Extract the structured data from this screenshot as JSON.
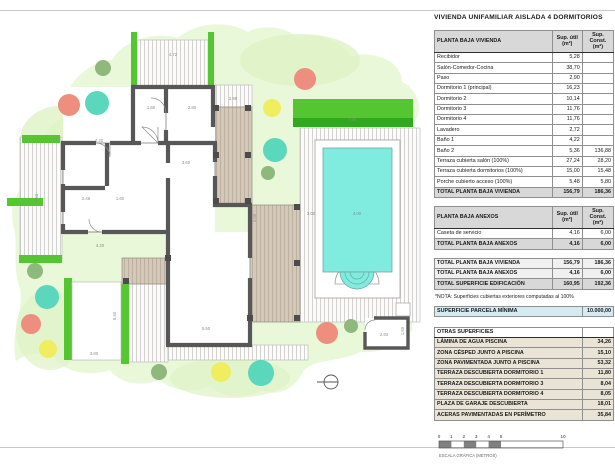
{
  "title": "VIVIENDA UNIFAMILIAR AISLADA 4 DORMITORIOS",
  "tables": {
    "vivienda": {
      "header_label": "PLANTA BAJA VIVIENDA",
      "col_util": "Sup. útil\n(m²)",
      "col_const": "Sup. Const.\n(m²)",
      "rows": [
        [
          "Recibidor",
          "5,28",
          ""
        ],
        [
          "Salón-Comedor-Cocina",
          "38,70",
          ""
        ],
        [
          "Paso",
          "2,90",
          ""
        ],
        [
          "Dormitorio 1 (principal)",
          "16,23",
          ""
        ],
        [
          "Dormitorio 2",
          "10,14",
          ""
        ],
        [
          "Dormitorio 3",
          "11,76",
          ""
        ],
        [
          "Dormitorio 4",
          "11,76",
          ""
        ],
        [
          "Lavadero",
          "2,72",
          ""
        ],
        [
          "Baño 1",
          "4,22",
          ""
        ],
        [
          "Baño 2",
          "5,36",
          "136,88"
        ],
        [
          "Terraza cubierta salón (100%)",
          "27,24",
          "28,20"
        ],
        [
          "Terraza cubierta dormitorios (100%)",
          "15,00",
          "15,48"
        ],
        [
          "Porche cubierto acceso (100%)",
          "5,48",
          "5,80"
        ]
      ],
      "total": [
        "TOTAL PLANTA BAJA VIVIENDA",
        "156,79",
        "186,36"
      ]
    },
    "anexos": {
      "header_label": "PLANTA BAJA ANEXOS",
      "col_util": "Sup. útil\n(m²)",
      "col_const": "Sup. Const.\n(m²)",
      "rows": [
        [
          "Caseta de servicio",
          "4,16",
          "6,00"
        ]
      ],
      "total": [
        "TOTAL PLANTA BAJA ANEXOS",
        "4,16",
        "6,00"
      ]
    },
    "resumen": {
      "rows": [
        [
          "TOTAL PLANTA BAJA VIVIENDA",
          "156,79",
          "186,36"
        ],
        [
          "TOTAL PLANTA BAJA ANEXOS",
          "4,16",
          "6,00"
        ],
        [
          "TOTAL SUPERFICIE EDIFICACIÓN",
          "160,95",
          "192,36"
        ]
      ]
    },
    "nota": "*NOTA: Superficies cubiertas exteriores computadas al 100%",
    "parcela": {
      "rows": [
        [
          "SUPERFICIE PARCELA MÍNIMA",
          "10.000,00"
        ]
      ]
    },
    "otras": {
      "header_label": "OTRAS SUPERFICIES",
      "rows": [
        [
          "LÁMINA DE AGUA PISCINA",
          "34,26"
        ],
        [
          "ZONA CÉSPED JUNTO A PISCINA",
          "15,10"
        ],
        [
          "ZONA PAVIMENTADA JUNTO A PISCINA",
          "53,32"
        ],
        [
          "TERRAZA DESCUBIERTA DORMITORIO 1",
          "11,80"
        ],
        [
          "TERRAZA DESCUBIERTA DORMITORIO 3",
          "8,04"
        ],
        [
          "TERRAZA DESCUBIERTA DORMITORIO 4",
          "8,05"
        ],
        [
          "PLAZA DE GARAJE DESCUBIERTA",
          "18,01"
        ],
        [
          "ACERAS PAVIMENTADAS EN PERÍMETRO",
          "35,84"
        ]
      ]
    }
  },
  "scalebar": {
    "ticks": [
      [
        0,
        "0"
      ],
      [
        1,
        "1"
      ],
      [
        2,
        "2"
      ],
      [
        3,
        "3"
      ],
      [
        4,
        "4"
      ],
      [
        5,
        "5"
      ],
      [
        10,
        "10"
      ]
    ],
    "filled_segments": [
      [
        0,
        1
      ],
      [
        2,
        3
      ],
      [
        4,
        5
      ]
    ],
    "label": "ESCALA GRÁFICA (METROS)"
  },
  "plan": {
    "colors": {
      "garden": "#e8f8d8",
      "garden_dark": "#def2c6",
      "hedge": "#53c631",
      "hedge_dark": "#2fa91d",
      "pool_water": "#7fecdf",
      "wall": "#575757",
      "column": "#4c4c4c",
      "terrace_tan": "#d3c9bb",
      "terrace_stripe": "#bdb09e",
      "pavement_stripe": "#d2d2d2",
      "tree_salmon": "#ee8e7e",
      "tree_teal": "#5ad7bd",
      "tree_yellow": "#f0ee60",
      "tree_olive": "#8fb87c"
    },
    "trees": [
      [
        103,
        68,
        8,
        "tree_olive"
      ],
      [
        69,
        105,
        11,
        "tree_salmon"
      ],
      [
        97,
        103,
        12,
        "tree_teal"
      ],
      [
        305,
        79,
        11,
        "tree_salmon"
      ],
      [
        272,
        108,
        9,
        "tree_yellow"
      ],
      [
        275,
        150,
        12,
        "tree_teal"
      ],
      [
        268,
        173,
        7,
        "tree_olive"
      ],
      [
        35,
        271,
        8,
        "tree_olive"
      ],
      [
        47,
        297,
        12,
        "tree_teal"
      ],
      [
        31,
        324,
        10,
        "tree_salmon"
      ],
      [
        48,
        349,
        9,
        "tree_yellow"
      ],
      [
        159,
        372,
        8,
        "tree_olive"
      ],
      [
        221,
        372,
        10,
        "tree_yellow"
      ],
      [
        261,
        373,
        13,
        "tree_teal"
      ],
      [
        327,
        333,
        11,
        "tree_salmon"
      ],
      [
        351,
        326,
        7,
        "tree_olive"
      ]
    ],
    "dimensions": [
      [
        "4.72",
        173,
        56,
        0
      ],
      [
        "2.98",
        233,
        100,
        0
      ],
      [
        "1.60",
        151,
        109,
        0
      ],
      [
        "2.80",
        192,
        109,
        0
      ],
      [
        "4.20",
        99,
        142,
        0
      ],
      [
        "2.46",
        86,
        200,
        0
      ],
      [
        "1.60",
        120,
        200,
        0
      ],
      [
        "3.60",
        38,
        198,
        1
      ],
      [
        "3.60",
        186,
        164,
        0
      ],
      [
        "4.20",
        100,
        247,
        0
      ],
      [
        "5.50",
        206,
        330,
        0
      ],
      [
        "5.40",
        116,
        316,
        1
      ],
      [
        "3.80",
        94,
        355,
        0
      ],
      [
        "7.50",
        352,
        121,
        0
      ],
      [
        "4.00",
        357,
        215,
        0
      ],
      [
        "3.00",
        311,
        215,
        0
      ],
      [
        "2.93",
        384,
        336,
        0
      ],
      [
        "1.60",
        404,
        331,
        1
      ],
      [
        "2.00",
        256,
        218,
        1
      ]
    ]
  }
}
